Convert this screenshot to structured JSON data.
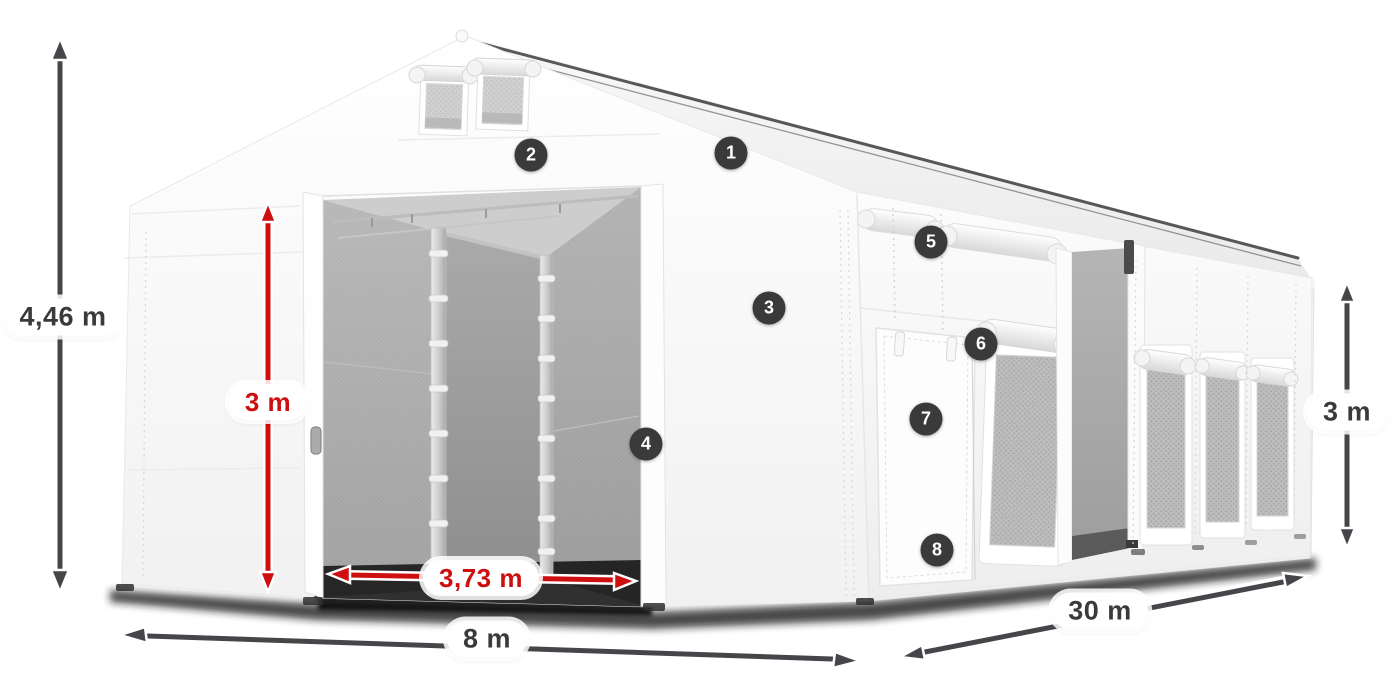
{
  "page": {
    "background_color": "#ffffff",
    "description": "3D product illustration of a white 8 x 30 m storage marquee tent with dimension arrows and numbered feature markers"
  },
  "colors": {
    "dimension_dark": "#46464a",
    "dimension_red": "#ce0f0f",
    "label_text_dark": "#3a3a3c",
    "label_background": "#ffffff",
    "marker_background": "#3a3a3a",
    "marker_text": "#ffffff",
    "tent_white": "#fbfbfb",
    "interior_gray": "#a8a8a8"
  },
  "diagram": {
    "dimensions": [
      {
        "id": "total-height",
        "value": "4,46 m",
        "style": "dark",
        "orientation": "vertical",
        "location": "left edge"
      },
      {
        "id": "entrance-height",
        "value": "3 m",
        "style": "red",
        "orientation": "vertical",
        "location": "front entrance"
      },
      {
        "id": "entrance-width",
        "value": "3,73 m",
        "style": "red",
        "orientation": "horizontal",
        "location": "front entrance"
      },
      {
        "id": "gable-width",
        "value": "8 m",
        "style": "dark",
        "orientation": "horizontal",
        "location": "front bottom"
      },
      {
        "id": "length",
        "value": "30 m",
        "style": "dark",
        "orientation": "diagonal",
        "location": "side bottom"
      },
      {
        "id": "side-height",
        "value": "3 m",
        "style": "dark",
        "orientation": "vertical",
        "location": "right edge"
      }
    ],
    "markers": [
      {
        "number": "1",
        "location": "roof"
      },
      {
        "number": "2",
        "location": "front gable header"
      },
      {
        "number": "3",
        "location": "front right wall"
      },
      {
        "number": "4",
        "location": "entrance right post"
      },
      {
        "number": "5",
        "location": "side wall upper panel"
      },
      {
        "number": "6",
        "location": "side window roll-up"
      },
      {
        "number": "7",
        "location": "side door flap"
      },
      {
        "number": "8",
        "location": "side door bottom"
      }
    ]
  }
}
